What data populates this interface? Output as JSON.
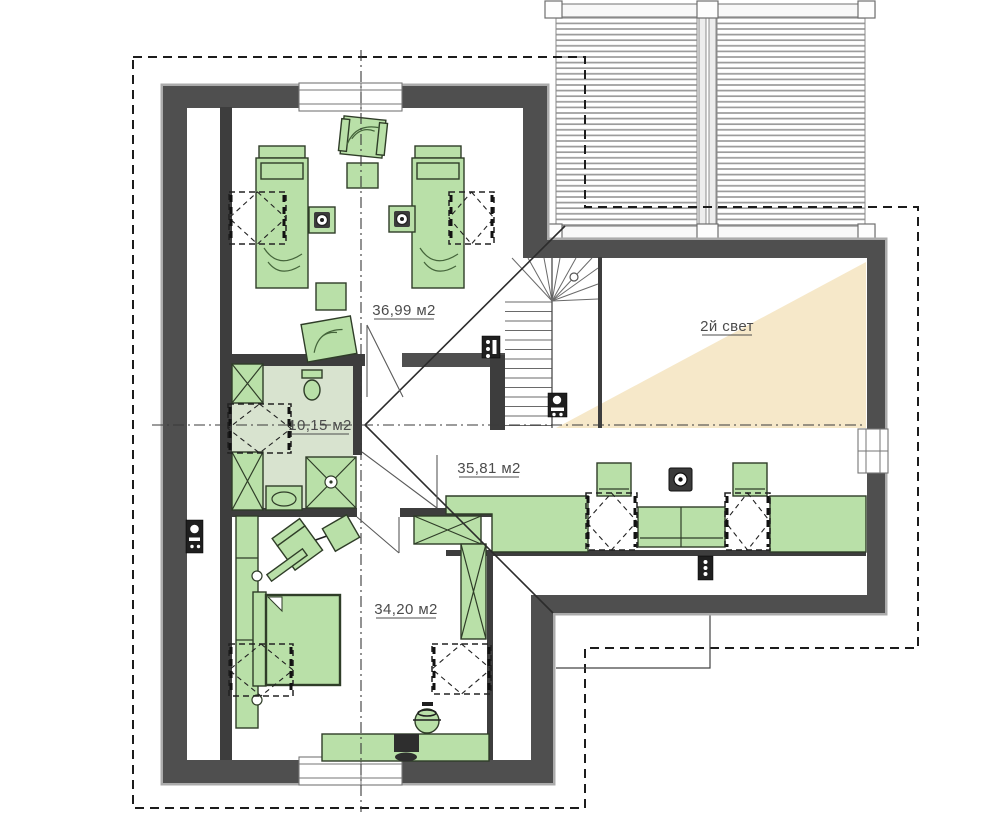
{
  "plan_labels": {
    "room_top_bedroom": "36,99 м2",
    "room_bathroom": "10,15 м2",
    "room_lounge": "35,81 м2",
    "room_bottom_bedroom": "34,20 м2",
    "void_space": "2й свет"
  },
  "colors": {
    "wall": "#4f4f4f",
    "wall_shadow": "#ababab",
    "furniture_fill": "#b9e0a8",
    "furniture_stroke": "#2f3d28",
    "bathroom_floor": "#d8e3cf",
    "light_beam": "#f6e8c9",
    "background": "#ffffff"
  }
}
